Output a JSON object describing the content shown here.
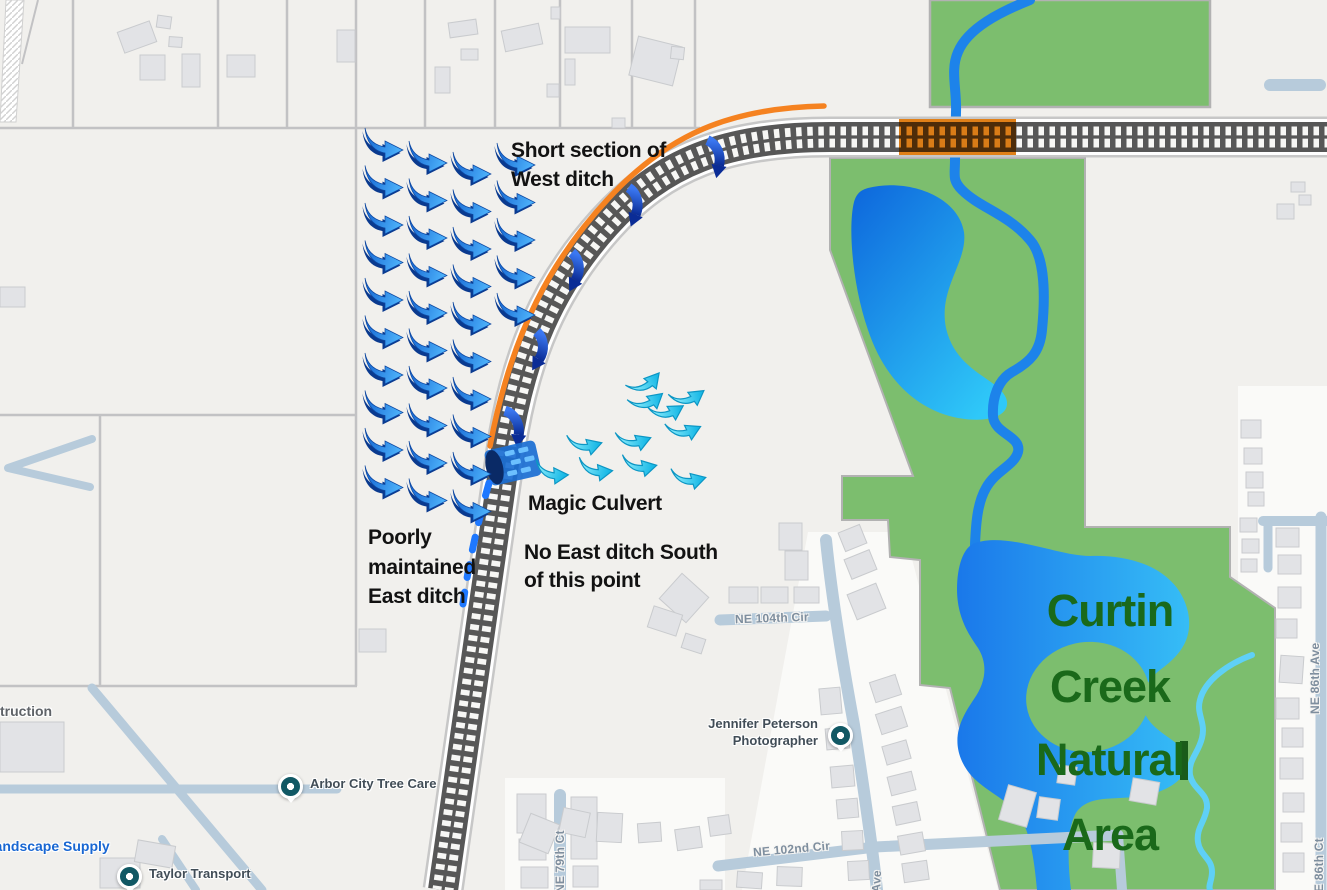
{
  "annotations": {
    "west_ditch": [
      "Short section of",
      "West ditch"
    ],
    "magic_culvert": "Magic Culvert",
    "no_east_ditch": [
      "No East ditch South",
      "of this point"
    ],
    "east_ditch": [
      "Poorly",
      "maintained",
      "East ditch"
    ]
  },
  "park_label": [
    "Curtin",
    "Creek",
    "Natural",
    "Area"
  ],
  "streets": {
    "ne104": "NE 104th Cir",
    "ne102": "NE 102nd Cir",
    "ne79": "NE 79th Ct",
    "ave": "Ave",
    "ne86ave": "NE 86th Ave",
    "e86ct": "E 86th Ct"
  },
  "places": {
    "arbor": "Arbor City Tree Care",
    "taylor": "Taylor Transport",
    "jennifer": [
      "Jennifer Peterson",
      "Photographer"
    ],
    "landscape": "Landscape Supply",
    "construction_partial": "truction"
  },
  "colors": {
    "bg": "#f1f0ed",
    "green": "#7cbe6e",
    "green_border": "#b2b2b2",
    "water": "#1d83ea",
    "water_light": "#5fd0f6",
    "pond_from": "#1a78ea",
    "pond_to": "#36bdf6",
    "upper_pond_from": "#0d66dc",
    "upper_pond_to": "#2fc8f8",
    "road": "#b7cbdb",
    "building_fill": "#e2e3e6",
    "building_stroke": "#c9cbce",
    "parcel": "#c2c2c4",
    "rail_dark": "#575757",
    "rail_casing": "#c7c7c7",
    "rail_gap": "#f7f7f5",
    "orange": "#f58220",
    "orange_block": "#e08018",
    "flow_from": "#1160cf",
    "flow_to": "#4aaef8",
    "flow_shadow": "#0a3a8f",
    "seep_from": "#9df4ff",
    "seep_to": "#17b8e6",
    "seep_stroke": "#0c96c4",
    "culvert_grad_from": "#3b78f2",
    "culvert_grad_to": "#0a2c96",
    "culvert_body": "#1a6ed2",
    "culvert_cap": "#0a2a66",
    "culvert_dash": "#6cc0ff",
    "ditch_dash": "#1e78ff",
    "tree_line": "#1a5c1a",
    "pocket": "#fafaf8"
  },
  "map": {
    "parcel_lines": [
      [
        0,
        128,
        700,
        128
      ],
      [
        73,
        0,
        73,
        128
      ],
      [
        218,
        0,
        218,
        128
      ],
      [
        287,
        0,
        287,
        128
      ],
      [
        356,
        0,
        356,
        686
      ],
      [
        425,
        0,
        425,
        128
      ],
      [
        495,
        0,
        495,
        128
      ],
      [
        560,
        0,
        560,
        128
      ],
      [
        632,
        0,
        632,
        128
      ],
      [
        695,
        0,
        695,
        128
      ],
      [
        0,
        415,
        356,
        415
      ],
      [
        100,
        415,
        100,
        686
      ],
      [
        0,
        686,
        357,
        686
      ]
    ],
    "extra_lines": [
      [
        38,
        0,
        22,
        64
      ]
    ],
    "hatch_poly": "6,0 24,0 16,122 0,122",
    "white_pockets": [
      "M808,532 L905,532 L998,890 L742,890 Z",
      "M1238,386 L1330,386 L1330,890 L1238,890 Z",
      "M505,778 L725,778 L725,890 L505,890 Z"
    ],
    "green_rect": [
      930,
      0,
      280,
      107
    ],
    "green_path": "M830,158 L1085,158 L1085,527 L1230,527 L1230,577 L1275,608 L1275,890 L1000,890 L950,688 L920,685 L920,560 L890,557 L888,520 L842,520 L842,476 L913,476 L830,250 Z",
    "island": {
      "cx": 1088,
      "cy": 697,
      "rx": 62,
      "ry": 55,
      "rot": -8
    },
    "tree_line": [
      1180,
      741,
      8,
      39
    ],
    "water": {
      "upper_pond": "M868,188 C908,178 958,196 964,232 C968,262 938,288 946,328 C956,372 998,378 1006,398 C1012,414 992,424 958,418 C916,410 884,378 868,330 C852,284 848,226 854,202 C857,192 862,190 868,188 Z",
      "creek": "M1030,0 C1000,12 968,28 958,52 C950,70 957,90 956,112 L955,160 C955,175 952,180 962,190 C980,208 1008,214 1030,240 C1046,258 1045,300 1042,330 C1040,352 1030,362 1012,372 C998,380 992,398 993,416 C994,434 1022,436 1018,452 C1014,466 996,470 986,488 C978,502 976,520 975,545",
      "pond": "M975,543 C1008,532 1058,556 1090,556 C1130,554 1178,568 1188,612 C1194,642 1176,658 1160,670 C1144,682 1138,700 1146,716 C1156,734 1180,740 1186,756 C1192,776 1170,790 1148,795 C1118,801 1094,794 1079,809 C1067,821 1067,858 1071,890 L1037,890 C1034,856 1029,824 1014,809 C994,791 971,784 961,759 C951,734 964,714 974,699 C986,682 988,664 978,648 C966,631 957,614 957,589 C957,567 963,547 975,543 Z",
      "squiggle": "M1252,655 C1228,664 1205,680 1200,700 C1196,714 1206,722 1202,738 C1198,754 1188,760 1190,775 C1193,790 1208,792 1207,808 C1205,822 1196,828 1198,842 C1200,856 1212,858 1212,872 C1212,881 1208,885 1210,890"
    },
    "roads": [
      {
        "d": "M720,620 L826,616",
        "w": 11
      },
      {
        "d": "M826,540 C832,600 842,660 854,725 C864,790 872,845 877,890",
        "w": 12
      },
      {
        "d": "M718,866 L875,847 L1118,835",
        "w": 11
      },
      {
        "d": "M1118,835 L1122,890",
        "w": 10
      },
      {
        "d": "M560,795 L560,890",
        "w": 12
      },
      {
        "d": "M1263,521 L1330,521",
        "w": 10
      },
      {
        "d": "M1268,524 L1268,568",
        "w": 9
      },
      {
        "d": "M1321,517 L1321,890",
        "w": 11
      },
      {
        "d": "M1270,85 L1320,85",
        "w": 12
      },
      {
        "d": "M92,439 L8,468 L90,487",
        "w": 8
      },
      {
        "d": "M0,789 L337,789",
        "w": 9
      },
      {
        "d": "M92,688 L177,789 L262,890",
        "w": 9
      },
      {
        "d": "M162,839 L196,890",
        "w": 8
      }
    ],
    "buildings": [
      [
        120,
        26,
        34,
        22,
        -20
      ],
      [
        157,
        16,
        14,
        12,
        8
      ],
      [
        169,
        37,
        13,
        10,
        4
      ],
      [
        140,
        55,
        25,
        25,
        0
      ],
      [
        182,
        54,
        18,
        33,
        0
      ],
      [
        227,
        55,
        28,
        22,
        0
      ],
      [
        337,
        30,
        18,
        32,
        0
      ],
      [
        449,
        21,
        28,
        15,
        -8
      ],
      [
        435,
        67,
        15,
        26,
        0
      ],
      [
        461,
        49,
        17,
        11,
        0
      ],
      [
        503,
        27,
        38,
        21,
        -12
      ],
      [
        551,
        7,
        9,
        12,
        0
      ],
      [
        565,
        27,
        45,
        26,
        0
      ],
      [
        565,
        59,
        10,
        26,
        0
      ],
      [
        547,
        84,
        12,
        13,
        0
      ],
      [
        612,
        118,
        13,
        10,
        0
      ],
      [
        633,
        41,
        45,
        40,
        14
      ],
      [
        671,
        47,
        13,
        12,
        6
      ],
      [
        0,
        287,
        25,
        20,
        0
      ],
      [
        0,
        722,
        64,
        50,
        0
      ],
      [
        359,
        629,
        27,
        23,
        0
      ],
      [
        100,
        858,
        40,
        30,
        0
      ],
      [
        136,
        843,
        38,
        22,
        10
      ],
      [
        1291,
        182,
        14,
        10,
        0
      ],
      [
        1299,
        195,
        12,
        10,
        0
      ],
      [
        1277,
        204,
        17,
        15,
        0
      ],
      [
        666,
        581,
        36,
        34,
        42
      ],
      [
        779,
        523,
        23,
        27,
        0
      ],
      [
        785,
        551,
        23,
        29,
        0
      ],
      [
        729,
        587,
        29,
        16,
        0
      ],
      [
        761,
        587,
        27,
        16,
        0
      ],
      [
        794,
        587,
        25,
        16,
        0
      ],
      [
        650,
        610,
        30,
        22,
        18
      ],
      [
        683,
        636,
        21,
        15,
        18
      ],
      [
        841,
        528,
        23,
        20,
        -22
      ],
      [
        847,
        554,
        27,
        21,
        -22
      ],
      [
        851,
        588,
        31,
        27,
        -22
      ],
      [
        872,
        678,
        27,
        21,
        -18
      ],
      [
        878,
        710,
        27,
        21,
        -18
      ],
      [
        884,
        743,
        25,
        19,
        -16
      ],
      [
        889,
        774,
        25,
        19,
        -14
      ],
      [
        894,
        804,
        25,
        19,
        -12
      ],
      [
        899,
        834,
        25,
        19,
        -10
      ],
      [
        903,
        862,
        25,
        19,
        -8
      ],
      [
        820,
        688,
        21,
        26,
        -5
      ],
      [
        826,
        728,
        23,
        21,
        -5
      ],
      [
        831,
        766,
        23,
        21,
        -5
      ],
      [
        837,
        799,
        21,
        19,
        -5
      ],
      [
        842,
        831,
        21,
        19,
        -3
      ],
      [
        848,
        861,
        21,
        19,
        -3
      ],
      [
        517,
        794,
        29,
        39,
        0
      ],
      [
        519,
        839,
        27,
        21,
        0
      ],
      [
        521,
        867,
        27,
        21,
        0
      ],
      [
        571,
        797,
        26,
        62,
        0
      ],
      [
        573,
        866,
        25,
        21,
        0
      ],
      [
        524,
        818,
        31,
        31,
        22
      ],
      [
        561,
        810,
        27,
        25,
        12
      ],
      [
        597,
        813,
        25,
        29,
        3
      ],
      [
        638,
        823,
        23,
        19,
        -4
      ],
      [
        676,
        828,
        25,
        21,
        -8
      ],
      [
        709,
        816,
        21,
        19,
        -8
      ],
      [
        737,
        872,
        25,
        16,
        4
      ],
      [
        777,
        867,
        25,
        19,
        2
      ],
      [
        700,
        880,
        22,
        10,
        0
      ],
      [
        1003,
        788,
        29,
        36,
        16
      ],
      [
        1038,
        798,
        21,
        21,
        8
      ],
      [
        1093,
        843,
        27,
        25,
        3
      ],
      [
        1131,
        780,
        27,
        23,
        10
      ],
      [
        1058,
        766,
        18,
        18,
        8
      ],
      [
        1240,
        518,
        17,
        14,
        0
      ],
      [
        1242,
        539,
        17,
        14,
        0
      ],
      [
        1241,
        559,
        16,
        13,
        0
      ],
      [
        1276,
        528,
        23,
        19,
        0
      ],
      [
        1278,
        555,
        23,
        19,
        0
      ],
      [
        1278,
        587,
        23,
        21,
        0
      ],
      [
        1276,
        619,
        21,
        19,
        0
      ],
      [
        1280,
        656,
        23,
        27,
        4
      ],
      [
        1276,
        698,
        23,
        21,
        0
      ],
      [
        1282,
        728,
        21,
        19,
        0
      ],
      [
        1280,
        758,
        23,
        21,
        0
      ],
      [
        1283,
        793,
        21,
        19,
        0
      ],
      [
        1281,
        823,
        21,
        19,
        0
      ],
      [
        1283,
        853,
        21,
        19,
        0
      ],
      [
        1241,
        420,
        20,
        18,
        0
      ],
      [
        1244,
        448,
        18,
        16,
        0
      ],
      [
        1246,
        472,
        17,
        16,
        0
      ],
      [
        1248,
        492,
        16,
        14,
        0
      ]
    ],
    "railroad": {
      "center": "M1330,137 L830,137 C725,137 662,162 606,224 C550,286 520,355 506,450 L443,890",
      "orange_rect": [
        899,
        119,
        117,
        36
      ],
      "orange_curve": "M824,106 C730,108 668,134 608,199 C553,258 512,330 490,446",
      "dashed_ditch": "M489,483 C479,518 469,560 463,604"
    },
    "culvert": {
      "x": 513,
      "y": 463,
      "rot": -13
    },
    "culvert_arrows": [
      [
        712,
        158,
        35
      ],
      [
        630,
        206,
        45
      ],
      [
        571,
        271,
        52
      ],
      [
        535,
        350,
        55
      ],
      [
        511,
        428,
        30
      ]
    ],
    "flow_grid": {
      "cols": [
        {
          "x": 365,
          "y0": 128,
          "n": 10
        },
        {
          "x": 409,
          "y0": 141,
          "n": 10
        },
        {
          "x": 453,
          "y0": 152,
          "n": 10
        },
        {
          "x": 497,
          "y0": 143,
          "n": 5
        }
      ],
      "dy": 37.5
    },
    "seep_arrows": [
      [
        552,
        471,
        -4
      ],
      [
        596,
        468,
        -8
      ],
      [
        640,
        464,
        -13
      ],
      [
        689,
        477,
        -16
      ],
      [
        585,
        443,
        -18
      ],
      [
        634,
        439,
        -22
      ],
      [
        684,
        429,
        -26
      ],
      [
        667,
        410,
        -32
      ],
      [
        647,
        400,
        -40
      ],
      [
        645,
        382,
        -50
      ],
      [
        688,
        396,
        -36
      ]
    ]
  }
}
